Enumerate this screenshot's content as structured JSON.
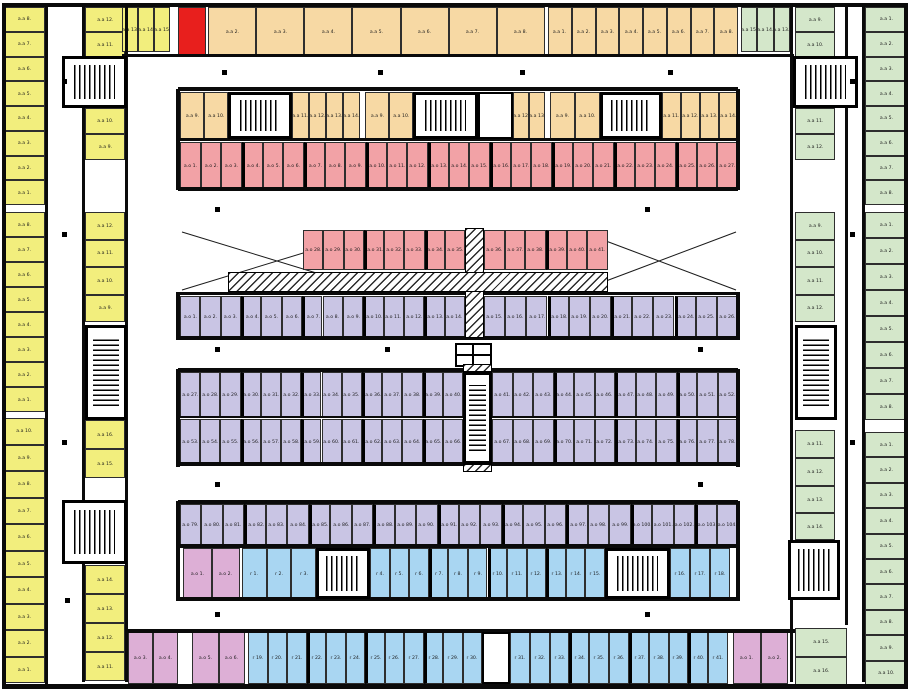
{
  "colors": {
    "yellow": "#f2ee7d",
    "orange": "#f7d9a4",
    "red": "#e81f1d",
    "pink": "#f2a2a6",
    "purple": "#c9c5e4",
    "blue": "#a9d6f2",
    "magenta": "#ddafd6",
    "green": "#d4e7ca",
    "wall": "#0a0a0a",
    "background": "#ffffff"
  },
  "zones": {
    "yellow_outer": {
      "prefix": "a.a ",
      "blocks": [
        [
          "8",
          "7",
          "6",
          "5",
          "4",
          "3",
          "2",
          "1"
        ],
        [
          "8",
          "7",
          "6",
          "5",
          "4",
          "3",
          "2",
          "1"
        ],
        [
          "10",
          "9",
          "8",
          "7",
          "6",
          "5",
          "4",
          "3",
          "2",
          "1"
        ]
      ]
    },
    "yellow_inner": {
      "prefix": "a.a ",
      "segments": [
        [
          "12",
          "11"
        ],
        [
          "10",
          "9"
        ],
        [
          "12",
          "11",
          "10",
          "9"
        ],
        [
          "16",
          "15"
        ],
        [
          "14",
          "13",
          "12",
          "11"
        ]
      ]
    },
    "yellow_top": {
      "prefix": "a.a ",
      "units": [
        "13",
        "14",
        "15"
      ]
    },
    "red_unit": {
      "prefix": "",
      "units": [
        ""
      ]
    },
    "orange_top": {
      "prefix": "a.a ",
      "group1": [
        "2",
        "3",
        "4",
        "5",
        "6",
        "7",
        "8"
      ],
      "group2": [
        "1",
        "2",
        "3",
        "4",
        "5",
        "6",
        "7",
        "8"
      ]
    },
    "green_top": {
      "prefix": "a.a ",
      "units": [
        "15",
        "14",
        "13"
      ]
    },
    "orange_mid": {
      "prefix": "a.a ",
      "g1a": [
        "9",
        "10"
      ],
      "g1b": [
        "11",
        "12",
        "13",
        "14"
      ],
      "g2a": [
        "9",
        "10"
      ],
      "g2b": [
        "12",
        "13"
      ],
      "g3a": [
        "9",
        "10"
      ],
      "g3b": [
        "11",
        "12",
        "13",
        "14"
      ]
    },
    "pink_row": {
      "prefix": "a.o ",
      "units": [
        "1",
        "2",
        "3",
        "4",
        "5",
        "6",
        "7",
        "8",
        "9",
        "10",
        "11",
        "12",
        "13",
        "14",
        "15",
        "16",
        "17",
        "18",
        "19",
        "20",
        "21",
        "22",
        "23",
        "24",
        "25",
        "26",
        "27"
      ]
    },
    "pink_mid": {
      "prefix": "a.o ",
      "left": [
        "28",
        "29",
        "30",
        "31",
        "32",
        "33",
        "34",
        "35"
      ],
      "right": [
        "36",
        "37",
        "38",
        "39",
        "40",
        "41"
      ]
    },
    "purple_row1": {
      "prefix": "a.o ",
      "left": [
        "1",
        "2",
        "3",
        "4",
        "5",
        "6",
        "7",
        "8",
        "9",
        "10",
        "11",
        "12",
        "13",
        "14"
      ],
      "right": [
        "15",
        "16",
        "17",
        "18",
        "19",
        "20",
        "21",
        "22",
        "23",
        "24",
        "25",
        "26"
      ]
    },
    "purple_double": {
      "prefix": "a.o ",
      "top_left": [
        "27",
        "28",
        "29",
        "30",
        "31",
        "32",
        "33",
        "34",
        "35",
        "36",
        "37",
        "38",
        "39",
        "40"
      ],
      "top_right": [
        "41",
        "42",
        "43",
        "44",
        "45",
        "46",
        "47",
        "48",
        "49",
        "50",
        "51",
        "52"
      ],
      "bottom_left": [
        "53",
        "54",
        "55",
        "56",
        "57",
        "58",
        "59",
        "60",
        "61",
        "62",
        "63",
        "64",
        "65",
        "66"
      ],
      "bottom_right": [
        "67",
        "68",
        "69",
        "70",
        "71",
        "72",
        "73",
        "74",
        "75",
        "76",
        "77",
        "78"
      ]
    },
    "purple_row2": {
      "prefix": "a.o ",
      "units": [
        "79",
        "80",
        "81",
        "82",
        "83",
        "84",
        "85",
        "86",
        "87",
        "88",
        "89",
        "90",
        "91",
        "92",
        "93",
        "94",
        "95",
        "96",
        "97",
        "98",
        "99",
        "100",
        "101",
        "102",
        "103",
        "104"
      ]
    },
    "magenta_g": {
      "prefix": "a.o ",
      "units": [
        "1",
        "2"
      ]
    },
    "blue_row1": {
      "prefix": "r ",
      "group1": [
        "1",
        "2",
        "3"
      ],
      "group2": [
        "4",
        "5",
        "6",
        "7",
        "8",
        "9",
        "10",
        "11",
        "12",
        "13",
        "14",
        "15"
      ],
      "group3": [
        "16",
        "17",
        "18"
      ]
    },
    "magenta_h1": {
      "prefix": "a.o ",
      "units": [
        "3",
        "4"
      ]
    },
    "magenta_h2": {
      "prefix": "a.o ",
      "units": [
        "5",
        "6"
      ]
    },
    "blue_row2": {
      "prefix": "r ",
      "left": [
        "19",
        "20",
        "21",
        "22",
        "23",
        "24",
        "25",
        "26",
        "27",
        "28",
        "29",
        "30"
      ],
      "right": [
        "31",
        "32",
        "33",
        "34",
        "35",
        "36",
        "37",
        "38",
        "39",
        "40",
        "41"
      ]
    },
    "magenta_h3": {
      "prefix": "a.o ",
      "units": [
        "1",
        "2"
      ]
    },
    "green_inner": {
      "prefix": "a.a ",
      "segments": [
        [
          "9",
          "10"
        ],
        [
          "11",
          "12"
        ],
        [
          "9",
          "10",
          "11",
          "12"
        ],
        [
          "11",
          "12"
        ],
        [
          "13",
          "14"
        ]
      ]
    },
    "green_corner": {
      "prefix": "a.a ",
      "units": [
        "15",
        "16"
      ]
    },
    "green_outer": {
      "prefix": "a.a ",
      "blocks": [
        [
          "1",
          "2",
          "3",
          "4",
          "5",
          "6",
          "7",
          "8"
        ],
        [
          "1",
          "2",
          "3",
          "4",
          "5",
          "6",
          "7",
          "8"
        ],
        [
          "1",
          "2",
          "3",
          "4",
          "5",
          "6",
          "7",
          "8",
          "9",
          "10"
        ]
      ]
    }
  }
}
